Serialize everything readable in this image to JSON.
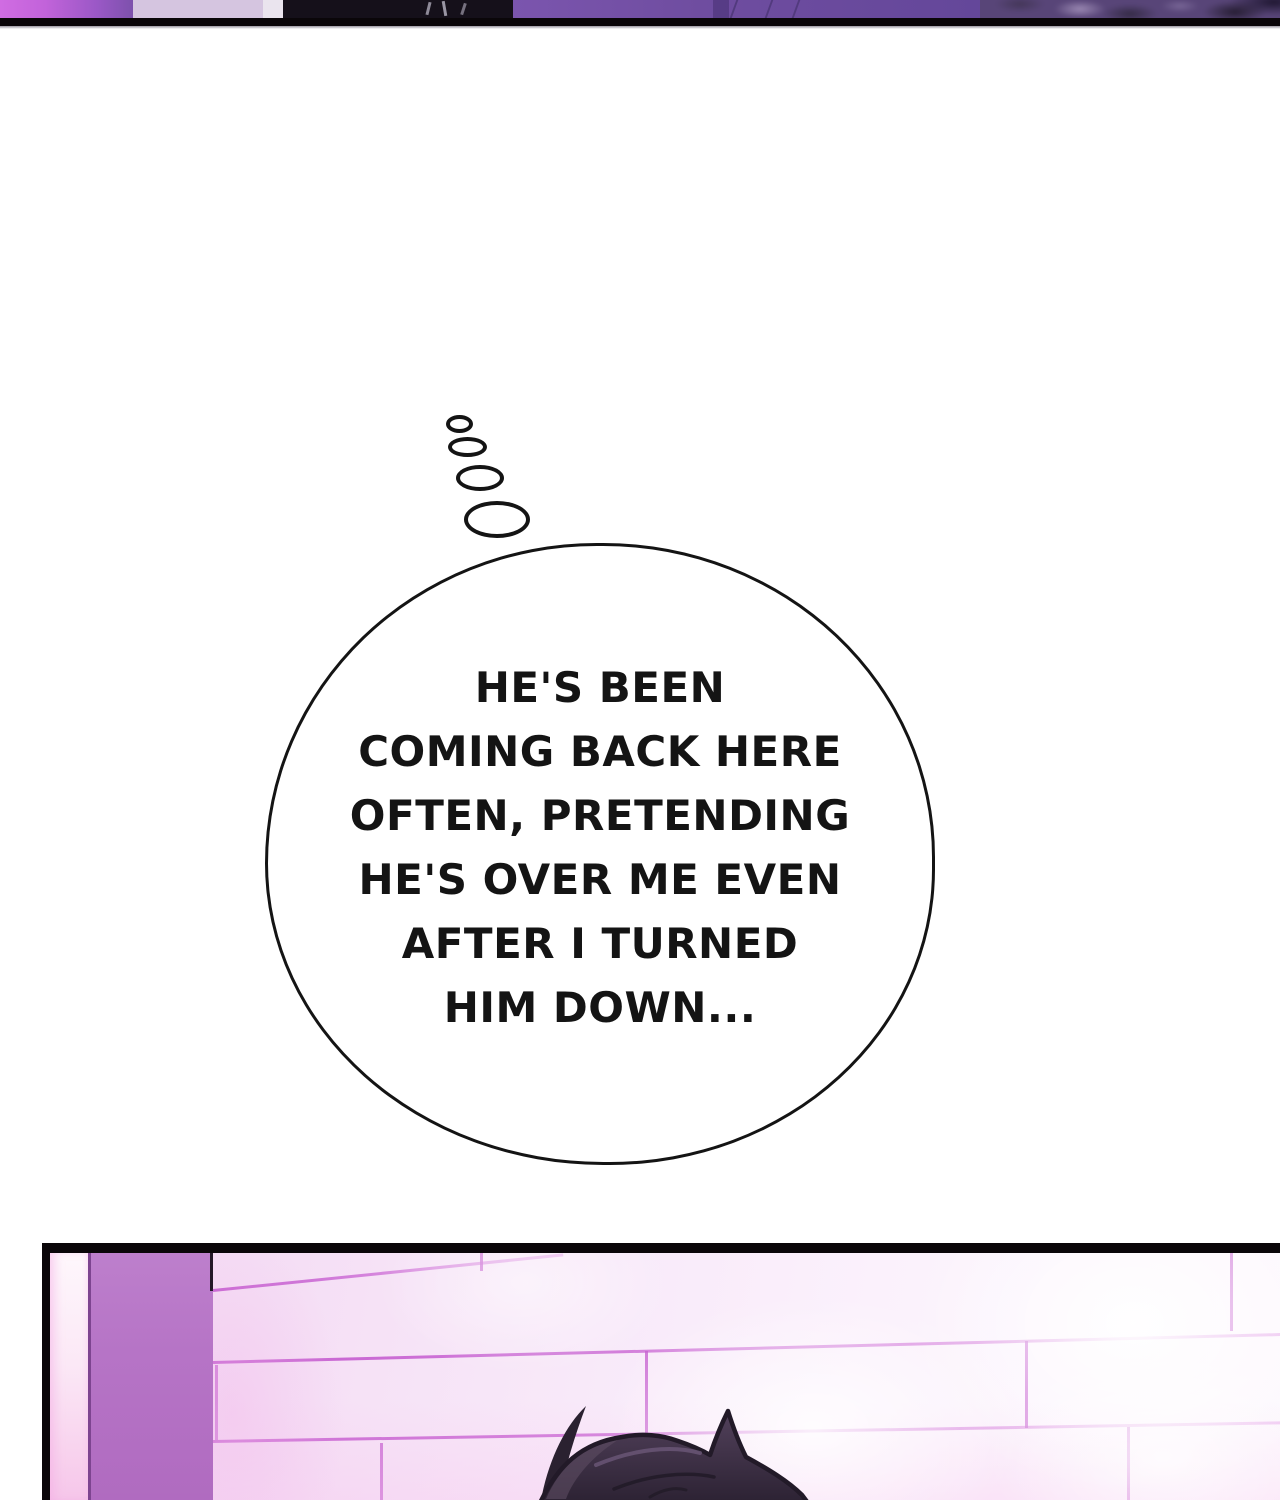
{
  "comic": {
    "thought_bubble": {
      "lines": [
        "HE'S BEEN",
        "COMING BACK HERE",
        "OFTEN, PRETENDING",
        "HE'S OVER ME EVEN",
        "AFTER I TURNED",
        "HIM DOWN..."
      ]
    },
    "colors": {
      "page_background": "#ffffff",
      "ink": "#141414",
      "panel_border": "#0a0609",
      "top_panel_glow": "#d06ce2",
      "top_panel_wall": "#6f4da0",
      "pillar": "#b674c6",
      "tile": "#f6e4f6",
      "tile_seam": "#c55fd0",
      "hair_dark": "#2e2435",
      "hair_light": "#5d4c63"
    }
  }
}
